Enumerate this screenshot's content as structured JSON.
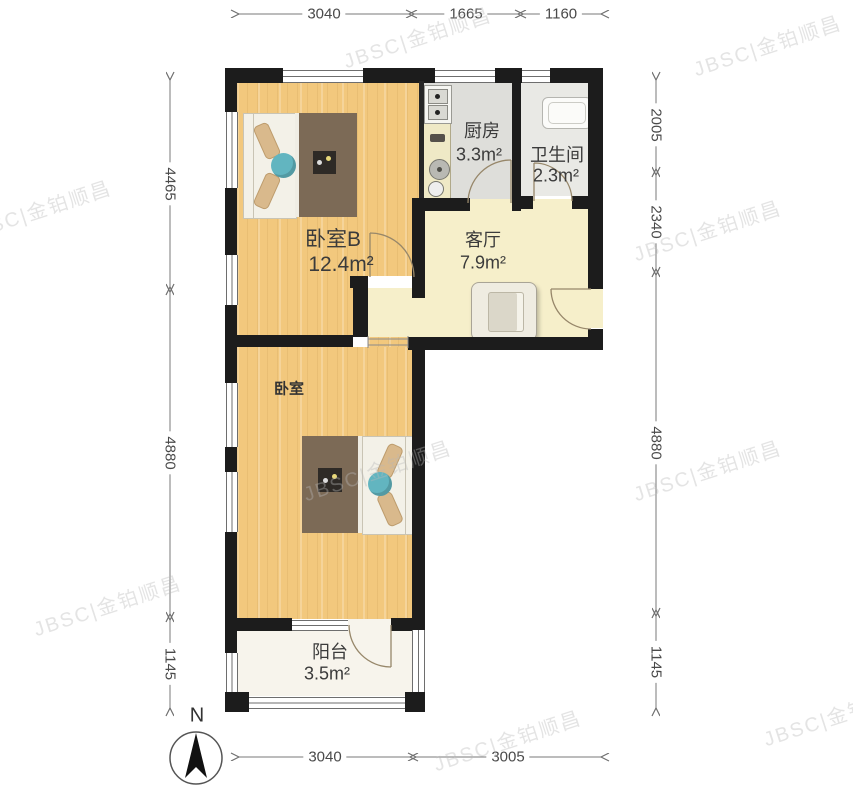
{
  "rooms": {
    "bedroom_b": {
      "name": "卧室B",
      "area": "12.4m²"
    },
    "kitchen": {
      "name": "厨房",
      "area": "3.3m²"
    },
    "bathroom": {
      "name": "卫生间",
      "area": "2.3m²"
    },
    "living": {
      "name": "客厅",
      "area": "7.9m²"
    },
    "bedroom": {
      "name": "卧室"
    },
    "balcony": {
      "name": "阳台",
      "area": "3.5m²"
    }
  },
  "dimensions": {
    "top": [
      "3040",
      "1665",
      "1160"
    ],
    "bottom": [
      "3040",
      "3005"
    ],
    "left": [
      "4465",
      "4880",
      "1145"
    ],
    "right": [
      "2005",
      "2340",
      "4880",
      "1145"
    ]
  },
  "compass": {
    "label": "N"
  },
  "watermark": {
    "text": "JBSC|金铂顺昌"
  },
  "colors": {
    "wall": "#1c1c1c",
    "wood_floor": "#f2c87d",
    "living_floor": "#f6efca",
    "kitchen_floor": "#dededa",
    "bathroom_floor": "#e9e9e5",
    "balcony_floor": "#f7f4ec",
    "blanket": "#7c6a56",
    "pillow": "#d9b98c",
    "accent_pillow": "#62b5c0"
  }
}
